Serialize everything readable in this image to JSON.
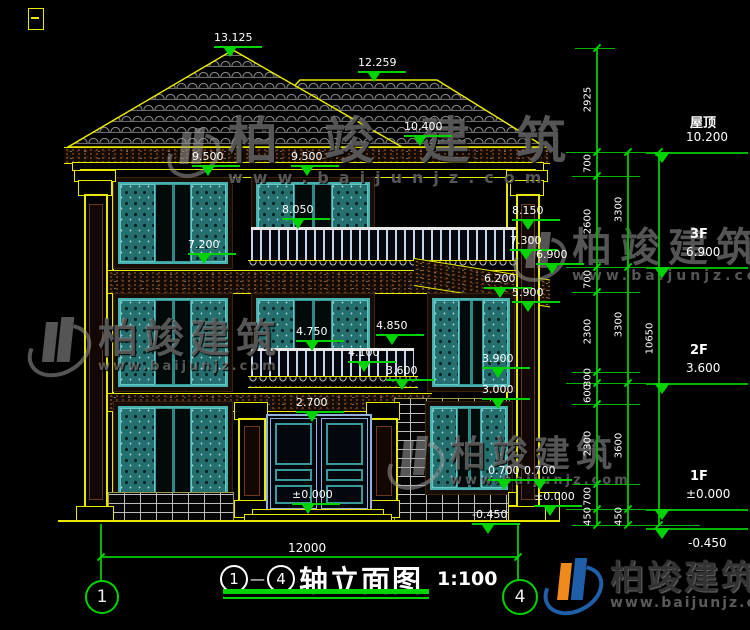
{
  "watermark": {
    "brand": "柏竣建筑",
    "url": "www.baijunjz.com"
  },
  "title": {
    "axis_start": "1",
    "separator": "—",
    "axis_end": "4",
    "name": "轴立面图",
    "scale": "1:100"
  },
  "ground": {
    "overall_width": "12000"
  },
  "axis_bubbles": {
    "left": "1",
    "right": "4"
  },
  "levels": [
    {
      "label": "屋顶",
      "value": "10.200"
    },
    {
      "label": "3F",
      "value": "6.900"
    },
    {
      "label": "2F",
      "value": "3.600"
    },
    {
      "label": "1F",
      "value": "±0.000"
    },
    {
      "label": "",
      "value": "-0.450"
    }
  ],
  "elevation_markers": [
    "13.125",
    "12.259",
    "10.400",
    "9.500",
    "9.500",
    "8.050",
    "7.200",
    "8.150",
    "7.300",
    "6.900",
    "6.200",
    "5.900",
    "4.750",
    "4.850",
    "4.100",
    "3.600",
    "3.900",
    "3.000",
    "2.700",
    "0.700",
    "0.700",
    "±0.000",
    "±0.000",
    "-0.450"
  ],
  "dim_chains": {
    "inner": [
      "2925",
      "700",
      "2600",
      "700",
      "2300",
      "300",
      "600",
      "2300",
      "700",
      "450"
    ],
    "middle": [
      "3300",
      "3300",
      "3600",
      "450"
    ],
    "outer": [
      "10650"
    ]
  },
  "colors": {
    "background": "#000000",
    "line_yellow": "#e8e800",
    "dim_green": "#00d400",
    "text_white": "#ffffff",
    "shutter_teal": "#2e7d7d",
    "logo_blue": "#1f5fa8",
    "logo_orange": "#f08a1d"
  }
}
